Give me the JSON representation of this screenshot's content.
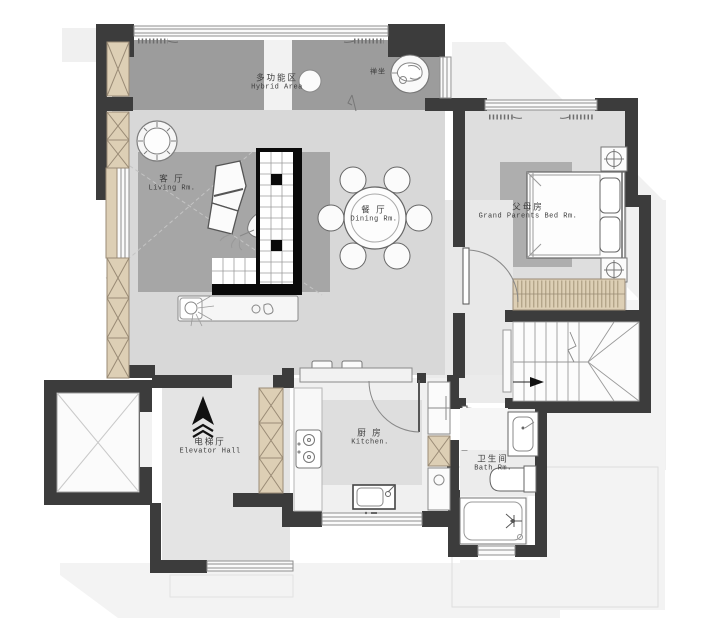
{
  "plan": {
    "name": "apartment-floor-plan",
    "rooms": [
      {
        "id": "hybrid",
        "zh": "多功能区",
        "en": "Hybrid Area"
      },
      {
        "id": "zen",
        "zh": "禅坐",
        "en": ""
      },
      {
        "id": "living",
        "zh": "客 厅",
        "en": "Living Rm."
      },
      {
        "id": "dining",
        "zh": "餐 厅",
        "en": "Dining Rm."
      },
      {
        "id": "bedroom",
        "zh": "父母房",
        "en": "Grand Parents Bed Rm."
      },
      {
        "id": "elevator",
        "zh": "电梯厅",
        "en": "Elevator Hall"
      },
      {
        "id": "kitchen",
        "zh": "厨 房",
        "en": "Kitchen."
      },
      {
        "id": "bath",
        "zh": "卫生间",
        "en": "Bath Rm."
      }
    ],
    "colors": {
      "wall": "#3c3c3c",
      "wood_fill": "#ddcfb5",
      "wood_line": "#9a8b76",
      "hybrid_floor": "#9c9c9c",
      "living_floor": "#d8d8d8",
      "rug": "#a6a6a6",
      "bedroom_rug": "#aeaeae",
      "shadow": "#f1f1f1",
      "line": "#777777"
    }
  }
}
